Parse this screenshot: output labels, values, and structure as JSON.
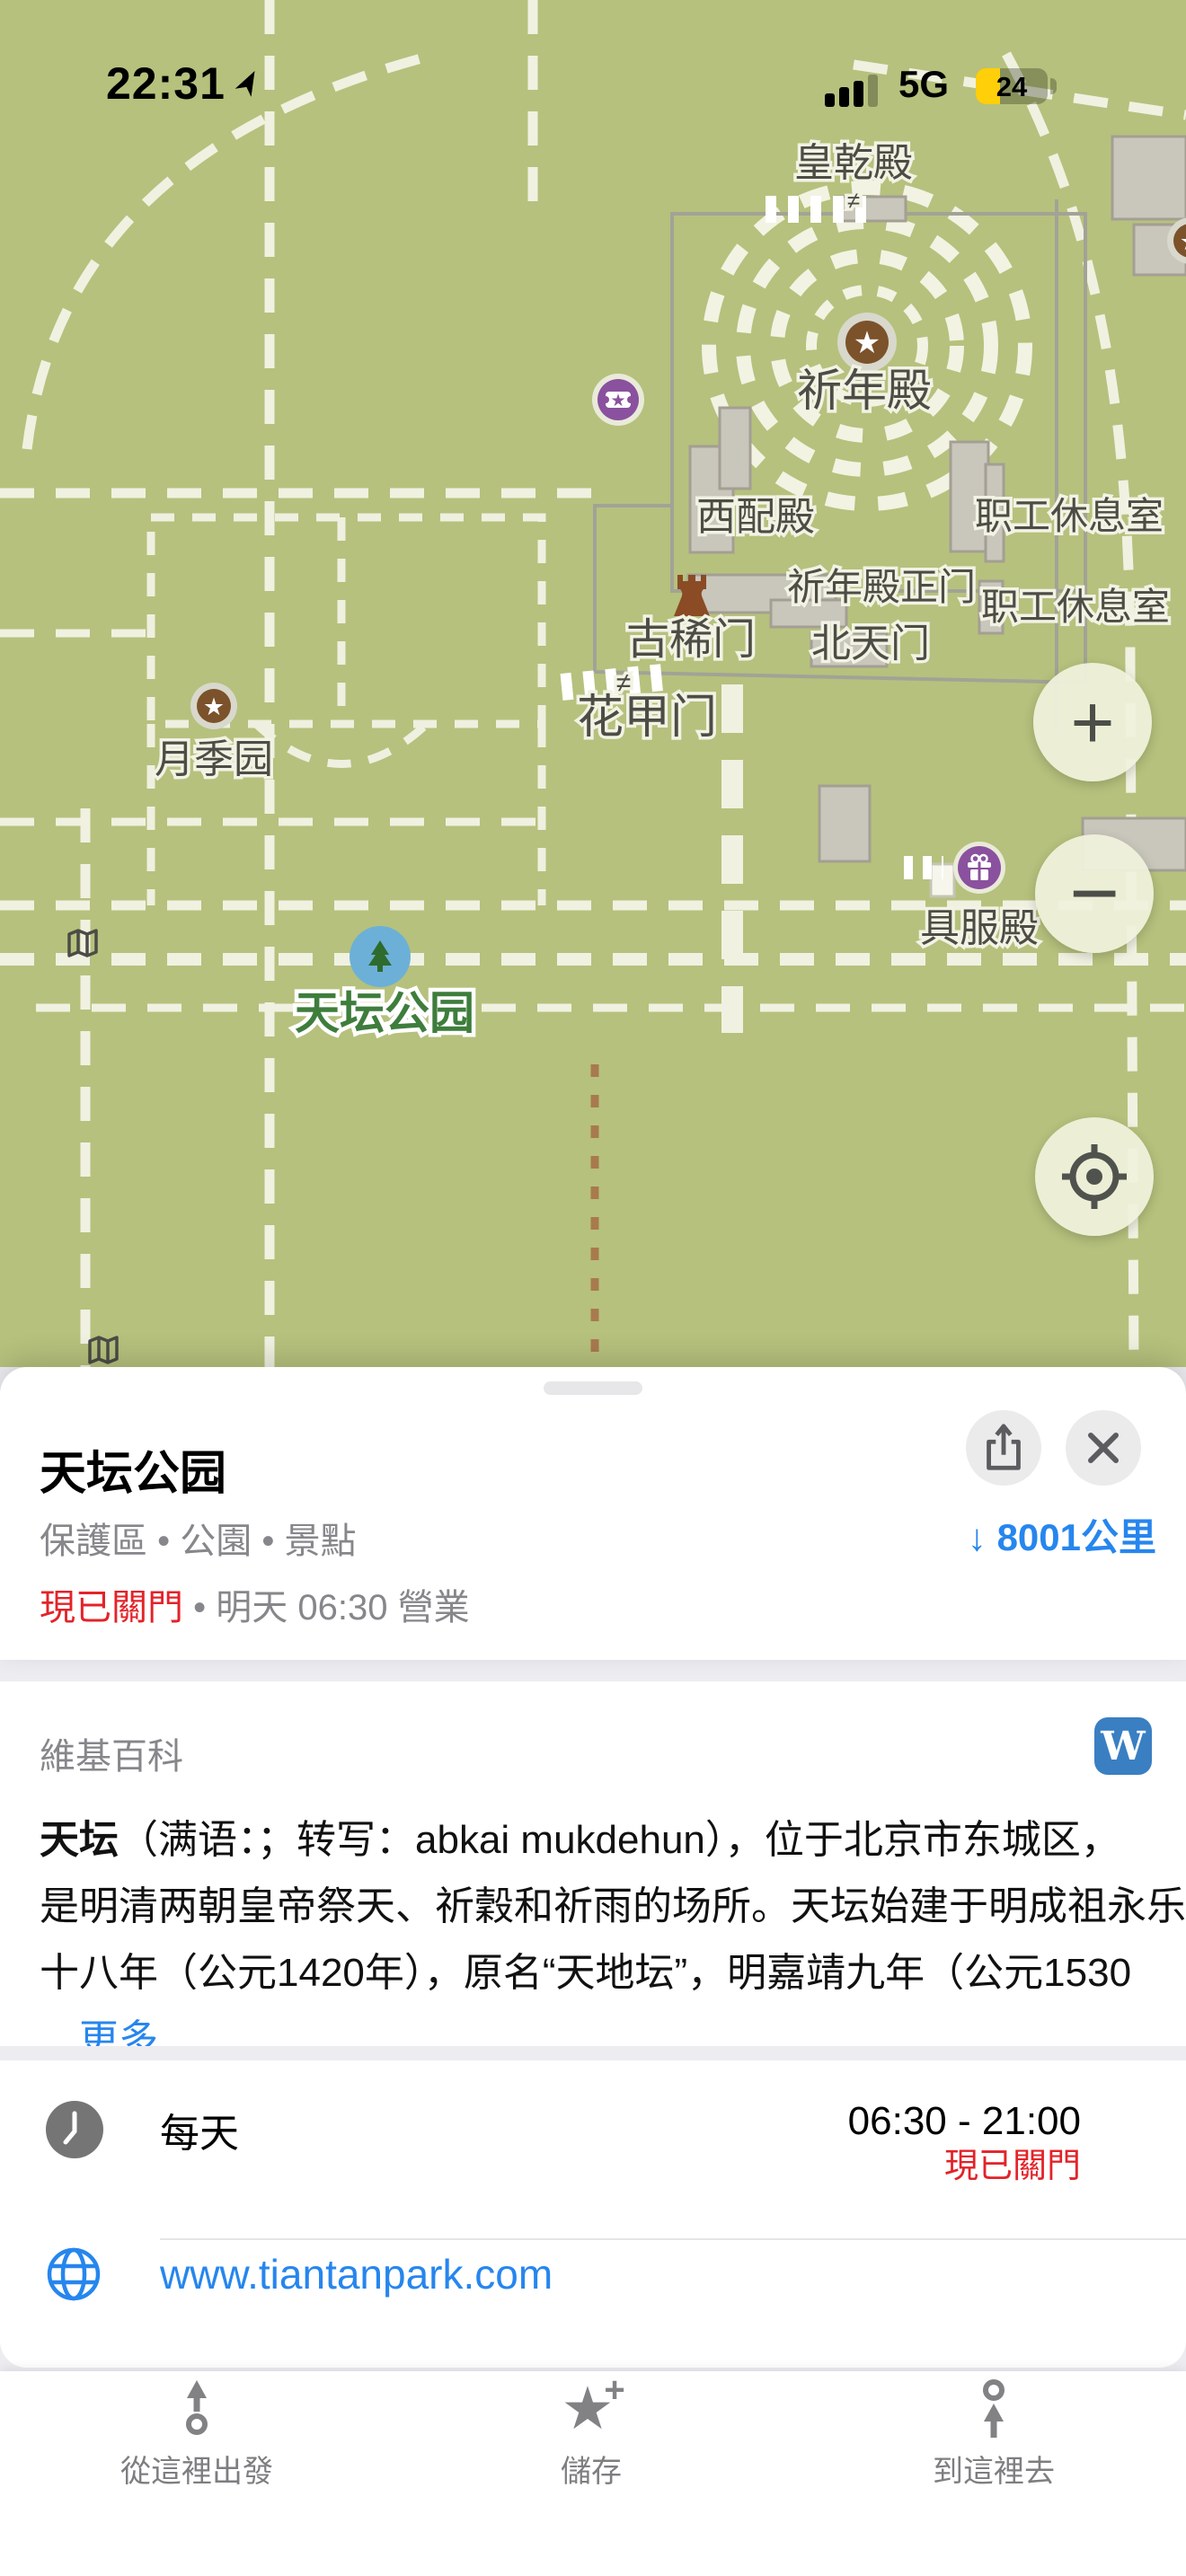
{
  "status_bar": {
    "time": "22:31",
    "network": "5G",
    "battery_percent": "24"
  },
  "icons": {
    "star": "★",
    "save_plus": "+",
    "down_arrow": "↓"
  },
  "map": {
    "labels": {
      "huangqiandian": "皇乾殿",
      "qiniandian": "祈年殿",
      "xipeidian": "西配殿",
      "zhigong_xiuxishi_1": "职工休息室",
      "qiniandian_zhengmen": "祈年殿正门",
      "zhigong_xiuxishi_2": "职工休息室",
      "beitianmen": "北天门",
      "guximen": "古稀门",
      "huajiamen": "花甲门",
      "yuejiyuan": "月季园",
      "jufudian": "具服殿",
      "park_name": "天坛公园",
      "gate_symbol": "≠"
    },
    "colors": {
      "ground": "#b6c17d",
      "path": "#f0f1e1",
      "building": "#c9c6bc",
      "poi_brown": "#7c522b",
      "poi_purple": "#8a519e",
      "park_marker_blue": "#6cb0d8",
      "park_label_green": "#3e7d3c"
    }
  },
  "map_controls": {
    "zoom_in": "+",
    "zoom_out": "−"
  },
  "sheet": {
    "title": "天坛公园",
    "category": "保護區 • 公園 • 景點",
    "distance": "8001公里",
    "closed_label": "現已關門",
    "open_info": "• 明天 06:30 營業",
    "wiki": {
      "header": "維基百科",
      "badge_letter": "W",
      "lead_bold": "天坛",
      "line1_rest": "（满语：；转写：abkai mukdehun），位于北京市东城区，",
      "line2": "是明清两朝皇帝祭天、祈穀和祈雨的场所。天坛始建于明成祖永乐",
      "line3": "十八年（公元1420年），原名“天地坛”，明嘉靖九年（公元1530",
      "more_link": "…更多"
    },
    "hours": {
      "days": "每天",
      "time_range": "06:30 - 21:00",
      "status": "現已關門"
    },
    "website": "www.tiantanpark.com"
  },
  "toolbar": {
    "from_here": "從這裡出發",
    "save": "儲存",
    "to_here": "到這裡去"
  }
}
